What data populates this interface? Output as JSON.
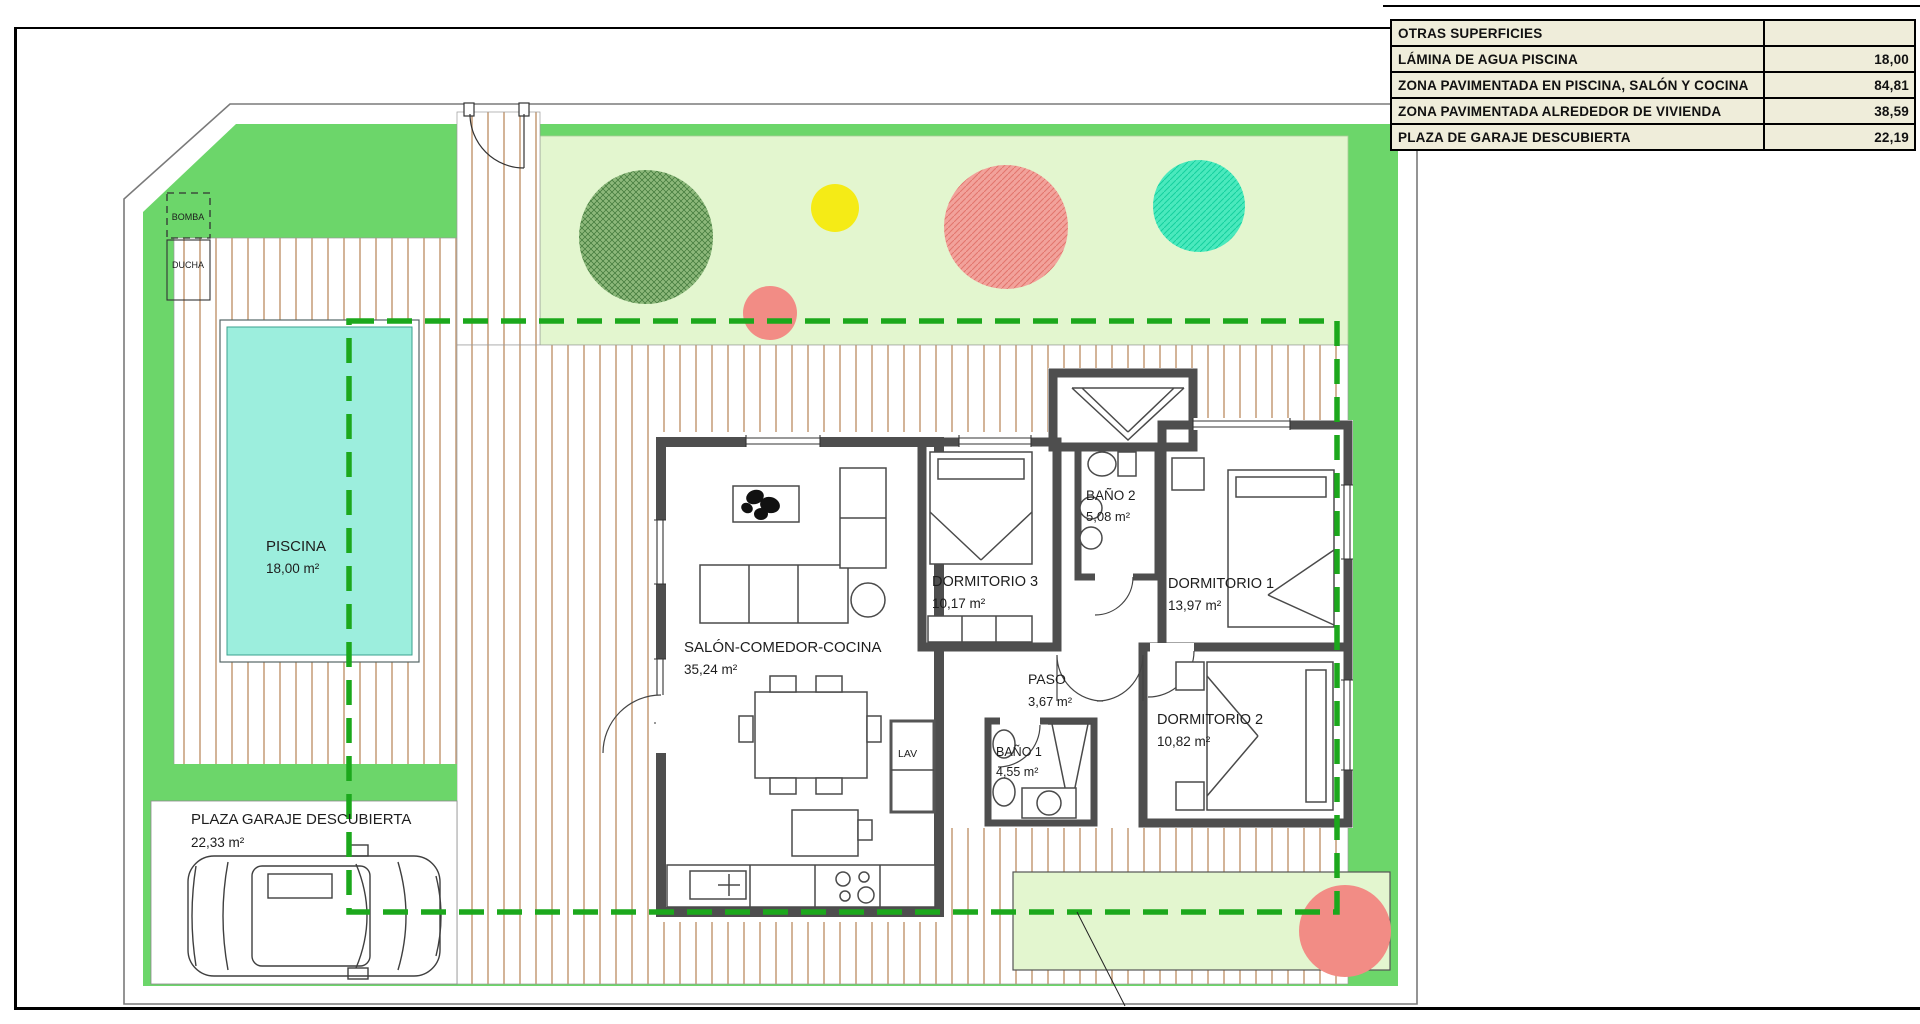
{
  "surfaces_table": {
    "title": "OTRAS SUPERFICIES",
    "rows": [
      {
        "label": "LÁMINA DE AGUA PISCINA",
        "value": "18,00"
      },
      {
        "label": "ZONA PAVIMENTADA EN PISCINA, SALÓN Y COCINA",
        "value": "84,81"
      },
      {
        "label": "ZONA PAVIMENTADA ALREDEDOR DE VIVIENDA",
        "value": "38,59"
      },
      {
        "label": "PLAZA DE GARAJE DESCUBIERTA",
        "value": "22,19"
      }
    ]
  },
  "labels": {
    "piscina_name": "PISCINA",
    "piscina_area": "18,00 m²",
    "salon_name": "SALÓN-COMEDOR-COCINA",
    "salon_area": "35,24 m²",
    "dorm3_name": "DORMITORIO 3",
    "dorm3_area": "10,17 m²",
    "dorm1_name": "DORMITORIO 1",
    "dorm1_area": "13,97 m²",
    "dorm2_name": "DORMITORIO 2",
    "dorm2_area": "10,82 m²",
    "bano2_name": "BAÑO 2",
    "bano2_area": "5,08 m²",
    "bano1_name": "BAÑO 1",
    "bano1_area": "4,55 m²",
    "paso_name": "PASO",
    "paso_area": "3,67 m²",
    "garaje_name": "PLAZA GARAJE DESCUBIERTA",
    "garaje_area": "22,33 m²",
    "lav": "LAV",
    "bomba": "BOMBA",
    "ducha": "DUCHA"
  },
  "colors": {
    "grass_green": "#6CD66A",
    "lawn_light": "#E3F6CF",
    "pool_water": "#9CEEDD",
    "paving_line": "#C8A27E",
    "wall_gray": "#4E4E4E",
    "boundary_dash_green": "#1CA81C",
    "tree_green": "#8CB87A",
    "tree_yellow": "#F5EB16",
    "tree_salmon": "#F28C85",
    "tree_teal": "#45E8BC",
    "table_bg": "#EFEDDA"
  }
}
